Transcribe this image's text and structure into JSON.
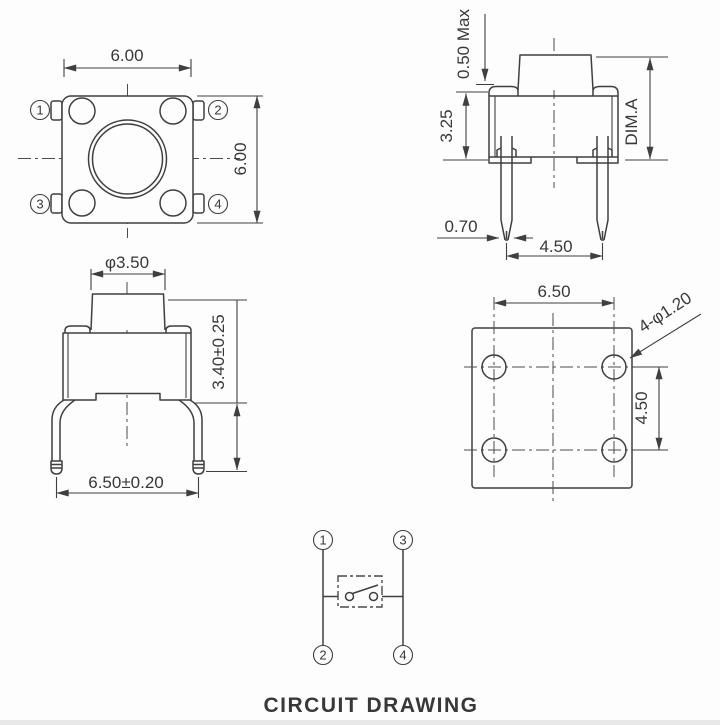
{
  "title": "CIRCUIT DRAWING",
  "colors": {
    "line": "#3f3f3f",
    "text": "#383838",
    "background": "#fdfdfd"
  },
  "views": {
    "top": {
      "dim_width": "6.00",
      "dim_height": "6.00",
      "pins": [
        "1",
        "2",
        "3",
        "4"
      ]
    },
    "side": {
      "dim_button_protrusion": "0.50 Max",
      "dim_body_height": "3.25",
      "dim_total_height": "DIM.A",
      "dim_lead_width": "0.70",
      "dim_lead_pitch": "4.50"
    },
    "front": {
      "dim_stem_diameter": "φ3.50",
      "dim_height_tolerance": "3.40±0.25",
      "dim_lead_span": "6.50±0.20"
    },
    "pcb": {
      "dim_pitch_x": "6.50",
      "dim_pitch_y": "4.50",
      "dim_holes": "4-φ1.20"
    },
    "circuit": {
      "pin_top_left": "1",
      "pin_top_right": "3",
      "pin_bottom_left": "2",
      "pin_bottom_right": "4",
      "caption": "CIRCUIT DRAWING"
    }
  }
}
